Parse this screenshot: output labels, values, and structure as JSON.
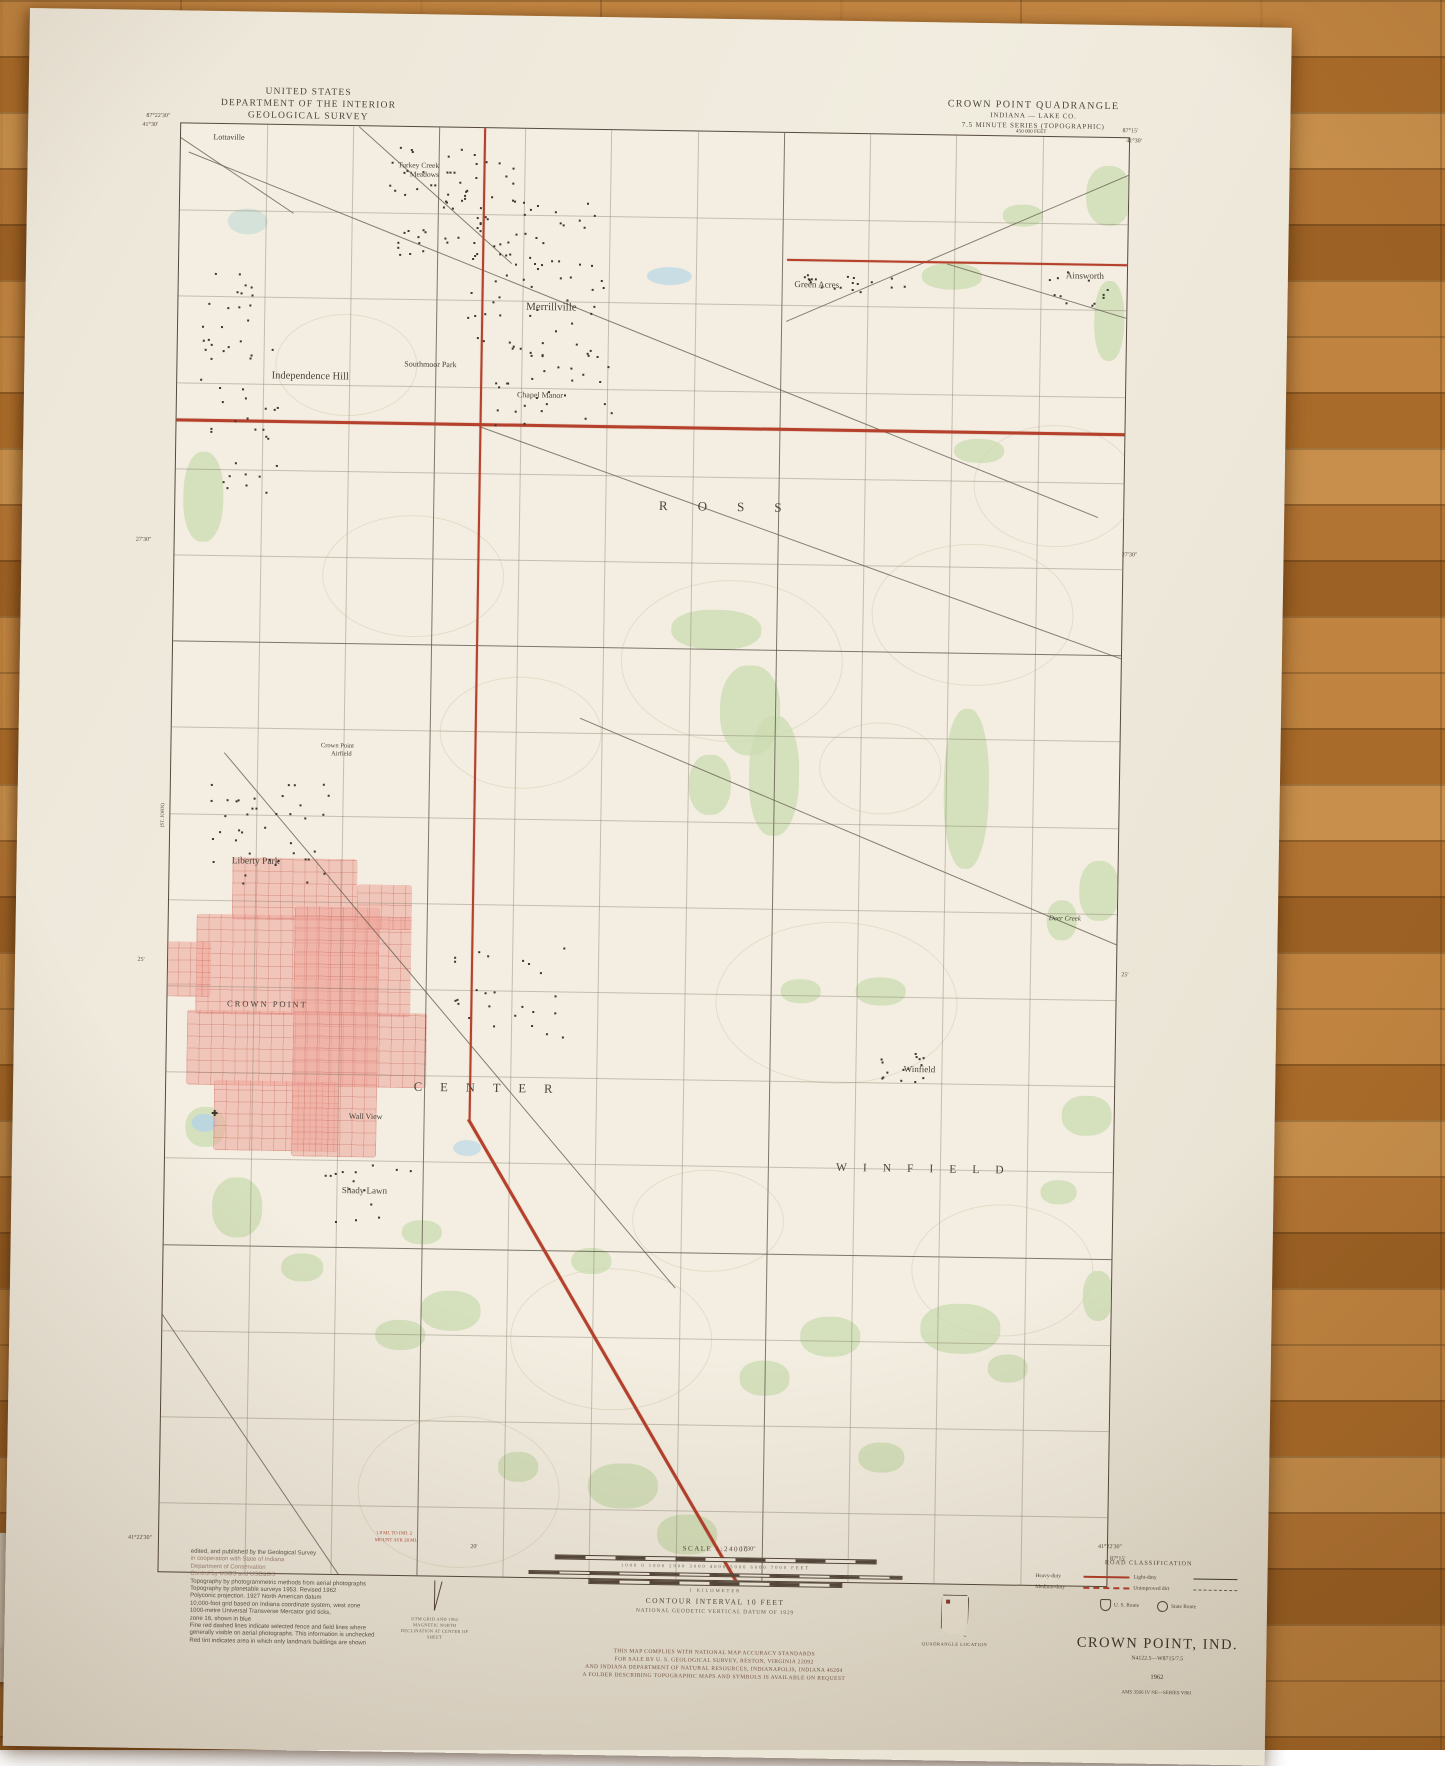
{
  "map": {
    "header_left": {
      "line1": "UNITED STATES",
      "line2": "DEPARTMENT OF THE INTERIOR",
      "line3": "GEOLOGICAL SURVEY"
    },
    "header_right": {
      "line1": "CROWN POINT QUADRANGLE",
      "line2": "INDIANA — LAKE CO.",
      "line3": "7.5 MINUTE SERIES (TOPOGRAPHIC)"
    },
    "place_labels": [
      {
        "text": "Lottaville",
        "x": 200,
        "y": 125,
        "s": 8
      },
      {
        "text": "Turkey Creek",
        "x": 390,
        "y": 150,
        "s": 7.5
      },
      {
        "text": "Meadows",
        "x": 396,
        "y": 159,
        "s": 7.5
      },
      {
        "text": "Merrillville",
        "x": 525,
        "y": 290,
        "s": 11
      },
      {
        "text": "Southmoor Park",
        "x": 405,
        "y": 349,
        "s": 8
      },
      {
        "text": "Independence Hill",
        "x": 285,
        "y": 363,
        "s": 10.5
      },
      {
        "text": "Chapel Manor",
        "x": 515,
        "y": 378,
        "s": 8
      },
      {
        "text": "Green Acres",
        "x": 790,
        "y": 263,
        "s": 9
      },
      {
        "text": "Ainsworth",
        "x": 1058,
        "y": 250,
        "s": 9
      },
      {
        "text": "ROSS",
        "x": 712,
        "y": 487,
        "s": 13,
        "ls": 30
      },
      {
        "text": "Crown Point",
        "x": 318,
        "y": 732,
        "s": 6.5
      },
      {
        "text": "Airfield",
        "x": 322,
        "y": 740,
        "s": 6.5
      },
      {
        "text": "Liberty Park",
        "x": 238,
        "y": 849,
        "s": 9.5
      },
      {
        "text": "CROWN POINT",
        "x": 252,
        "y": 991,
        "s": 8.5,
        "ls": 2
      },
      {
        "text": "CENTER",
        "x": 478,
        "y": 1072,
        "s": 12.5,
        "ls": 18
      },
      {
        "text": "Winfield",
        "x": 905,
        "y": 1046,
        "s": 9
      },
      {
        "text": "WINFIELD",
        "x": 915,
        "y": 1146,
        "s": 11.5,
        "ls": 16
      },
      {
        "text": "Wall View",
        "x": 352,
        "y": 1102,
        "s": 8
      },
      {
        "text": "Shady Lawn",
        "x": 352,
        "y": 1176,
        "s": 9
      },
      {
        "text": "Deer Creek",
        "x": 1048,
        "y": 893,
        "s": 7,
        "i": true
      }
    ],
    "edge_labels": [
      {
        "text": "87°22'30\"",
        "x": 130,
        "y": 106,
        "s": 6
      },
      {
        "text": "41°30'",
        "x": 122,
        "y": 115,
        "s": 6
      },
      {
        "text": "450 000 FEET",
        "x": 1003,
        "y": 108,
        "s": 5.2
      },
      {
        "text": "87°15'",
        "x": 1102,
        "y": 106,
        "s": 6
      },
      {
        "text": "41°30'",
        "x": 1106,
        "y": 116,
        "s": 6
      },
      {
        "text": "27'30\"",
        "x": 122,
        "y": 530,
        "s": 6
      },
      {
        "text": "27'30\"",
        "x": 1108,
        "y": 530,
        "s": 6
      },
      {
        "text": "25'",
        "x": 126,
        "y": 950,
        "s": 6
      },
      {
        "text": "25'",
        "x": 1110,
        "y": 950,
        "s": 6
      },
      {
        "text": "41°22'30\"",
        "x": 134,
        "y": 1528,
        "s": 6
      },
      {
        "text": "41°22'30\"",
        "x": 1104,
        "y": 1522,
        "s": 6
      },
      {
        "text": "87°15'",
        "x": 1112,
        "y": 1534,
        "s": 6
      },
      {
        "text": "20'",
        "x": 468,
        "y": 1532,
        "s": 6
      },
      {
        "text": "17'30\"",
        "x": 742,
        "y": 1530,
        "s": 6
      },
      {
        "text": "1.8 MI. TO IND. 2",
        "x": 388,
        "y": 1520,
        "s": 4.8,
        "c": "#b14a38"
      },
      {
        "text": "MOUNT AYR 28 MI.",
        "x": 390,
        "y": 1527,
        "s": 4.8,
        "c": "#b14a38"
      },
      {
        "text": "(ST. JOHN)",
        "x": 146,
        "y": 805,
        "s": 5,
        "rot": -90
      }
    ],
    "legend": {
      "scale_title": "SCALE 1:24000",
      "feet_row": "1000    0    1000   2000   3000   4000   5000   6000   7000 FEET",
      "mile_label": "1 MILE",
      "km_label": "1 KILOMETER",
      "contour": "CONTOUR INTERVAL 10 FEET",
      "datum": "NATIONAL GEODETIC VERTICAL DATUM OF 1929",
      "compliance": [
        "THIS MAP COMPLIES WITH NATIONAL MAP ACCURACY STANDARDS",
        "FOR SALE BY U. S. GEOLOGICAL SURVEY, RESTON, VIRGINIA 22092",
        "AND INDIANA DEPARTMENT OF NATURAL RESOURCES, INDIANAPOLIS, INDIANA 46204",
        "A FOLDER DESCRIBING TOPOGRAPHIC MAPS AND SYMBOLS IS AVAILABLE ON REQUEST"
      ],
      "road_class": {
        "title": "ROAD CLASSIFICATION",
        "rows": [
          {
            "label": "Heavy-duty",
            "style": "red-solid"
          },
          {
            "label": "Light-duty",
            "style": "black-solid"
          },
          {
            "label": "Medium-duty",
            "style": "red-dash"
          },
          {
            "label": "Unimproved dirt",
            "style": "gray-dash"
          }
        ],
        "routes": [
          {
            "label": "U. S. Route",
            "icon": "us-shield-icon"
          },
          {
            "label": "State Route",
            "icon": "state-circle-icon"
          }
        ]
      },
      "title_block": {
        "title": "CROWN POINT, IND.",
        "coords": "N4122.5—W8715/7.5",
        "year": "1962",
        "series": "AMS 3566 IV NE—SERIES V861"
      },
      "quadrangle_location": "QUADRANGLE LOCATION",
      "declination": [
        "UTM GRID AND 1962 MAGNETIC NORTH",
        "DECLINATION AT CENTER OF SHEET"
      ]
    },
    "credits": [
      {
        "t": "edited, and published by the Geological Survey",
        "coop": false
      },
      {
        "t": "in cooperation with State of Indiana",
        "coop": true
      },
      {
        "t": "Department of Conservation",
        "coop": true
      },
      {
        "t": "Control by USGS and USC&GS",
        "coop": true
      },
      {
        "t": "Topography by photogrammetric methods from aerial photographs",
        "coop": false
      },
      {
        "t": "Topography by planetable surveys 1953.  Revised 1962",
        "coop": false
      },
      {
        "t": "Polyconic projection.  1927 North American datum",
        "coop": false
      },
      {
        "t": "10,000-foot grid based on Indiana coordinate system, west zone",
        "coop": false
      },
      {
        "t": "1000-metre Universal Transverse Mercator grid ticks,",
        "coop": false
      },
      {
        "t": "zone 16, shown in blue",
        "coop": false
      },
      {
        "t": "Fine red dashed lines indicate selected fence and field lines where",
        "coop": false
      },
      {
        "t": "generally visible on aerial photographs.  This information is unchecked",
        "coop": false
      },
      {
        "t": "Red tint indicates area in which only landmark buildings are shown",
        "coop": false
      }
    ],
    "colors": {
      "highway_red": "#b5402c",
      "urban_tint": "#eea59b",
      "woodland_green": "#cddcb3",
      "paper": "#f3eee1"
    }
  }
}
